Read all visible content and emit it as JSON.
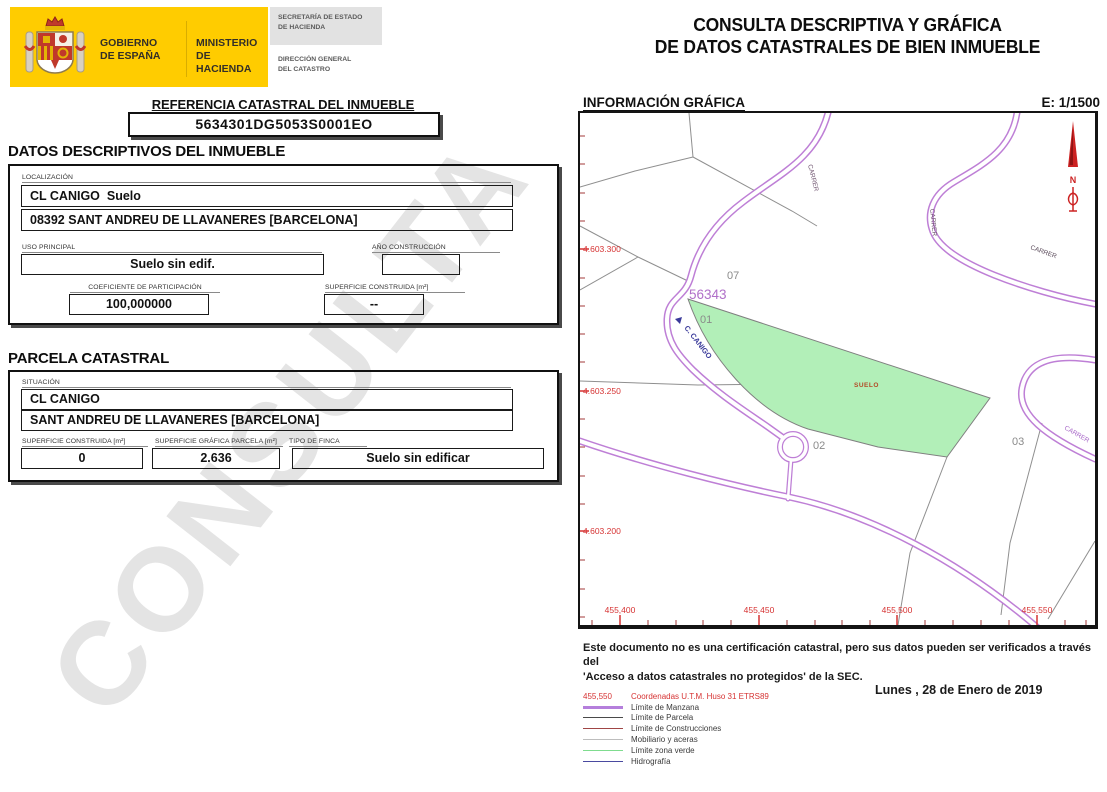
{
  "header": {
    "gobierno_line1": "GOBIERNO",
    "gobierno_line2": "DE ESPAÑA",
    "ministerio_line1": "MINISTERIO",
    "ministerio_line2": "DE HACIENDA",
    "secretaria_line1": "SECRETARÍA DE ESTADO",
    "secretaria_line2": "DE HACIENDA",
    "direccion_line1": "DIRECCIÓN GENERAL",
    "direccion_line2": "DEL CATASTRO",
    "title_line1": "CONSULTA DESCRIPTIVA Y GRÁFICA",
    "title_line2": "DE DATOS CATASTRALES DE BIEN INMUEBLE"
  },
  "referencia": {
    "heading": "REFERENCIA CATASTRAL DEL INMUEBLE",
    "value": "5634301DG5053S0001EO"
  },
  "datos_descriptivos": {
    "heading": "DATOS DESCRIPTIVOS DEL INMUEBLE",
    "localizacion_label": "LOCALIZACIÓN",
    "localizacion_line1": "CL CANIGO  Suelo",
    "localizacion_line2": "08392 SANT ANDREU DE LLAVANERES [BARCELONA]",
    "uso_principal_label": "USO PRINCIPAL",
    "uso_principal": "Suelo sin edif.",
    "ano_construccion_label": "AÑO CONSTRUCCIÓN",
    "ano_construccion": "",
    "coeficiente_label": "COEFICIENTE DE PARTICIPACIÓN",
    "coeficiente": "100,000000",
    "superficie_construida_label": "SUPERFICIE CONSTRUIDA [m²]",
    "superficie_construida": "--"
  },
  "parcela": {
    "heading": "PARCELA CATASTRAL",
    "situacion_label": "SITUACIÓN",
    "situacion_line1": "CL CANIGO",
    "situacion_line2": "SANT ANDREU DE LLAVANERES [BARCELONA]",
    "superficie_construida_label": "SUPERFICIE CONSTRUIDA [m²]",
    "superficie_construida": "0",
    "superficie_grafica_label": "SUPERFICIE GRÁFICA PARCELA [m²]",
    "superficie_grafica": "2.636",
    "tipo_finca_label": "TIPO DE FINCA",
    "tipo_finca": "Suelo sin edificar"
  },
  "watermark": "CONSULTA",
  "mapa": {
    "heading": "INFORMACIÓN GRÁFICA",
    "escala": "E: 1/1500",
    "labels": {
      "manzana": "56343",
      "parcel_07": "07",
      "parcel_01": "01",
      "parcel_02": "02",
      "parcel_03": "03",
      "suelo": "SUELO",
      "street_canigo": "C. CANIGO",
      "street_carrer_top": "CARRER",
      "street_carrer_right": "CARRER",
      "street_carrer_east": "CARRER",
      "street_carrer_southeast": "CARRER",
      "north": "N"
    },
    "y_ticks": [
      "4.603.300",
      "4.603.250",
      "4.603.200"
    ],
    "x_ticks": [
      "455,400",
      "455,450",
      "455,500",
      "455,550"
    ]
  },
  "footer": {
    "disclaimer_line1": "Este documento no es una certificación catastral, pero sus datos pueden ser verificados a través del",
    "disclaimer_line2": "'Acceso a datos catastrales no protegidos' de la SEC.",
    "fecha": "Lunes , 28 de Enero de 2019",
    "legend": [
      {
        "prefix": "455,550",
        "label": "Coordenadas U.T.M. Huso 31 ETRS89"
      },
      {
        "color": "#b57fdc",
        "thick": true,
        "label": "Límite de Manzana"
      },
      {
        "color": "#4a4a4a",
        "label": "Límite de Parcela"
      },
      {
        "color": "#a04545",
        "label": "Límite de Construcciones"
      },
      {
        "color": "#bdbdbd",
        "label": "Mobiliario y aceras"
      },
      {
        "color": "#7fdc8f",
        "label": "Límite zona verde"
      },
      {
        "color": "#4a4aa0",
        "label": "Hidrografía"
      }
    ]
  }
}
